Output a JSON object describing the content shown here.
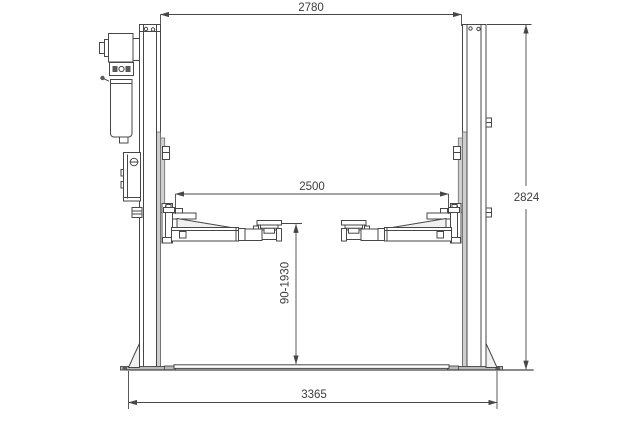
{
  "drawing": {
    "title": "Two-post car lift dimensional drawing (front view)",
    "view": "front elevation with floor plate",
    "dimensions": {
      "top_width": "2780",
      "arm_span": "2500",
      "column_height": "2824",
      "lift_height_range": "90-1930",
      "base_width": "3365"
    },
    "components": [
      "left column",
      "right column",
      "motor",
      "hydraulic pump",
      "oil tank",
      "control box",
      "lift carriage",
      "telescopic swing arm",
      "lift pad",
      "floor cover plate",
      "base plate",
      "column gusset"
    ],
    "colors": {
      "line": "#474747",
      "shading": "#cfcfcf",
      "plate_gray": "#b9b9b9",
      "background": "#ffffff"
    }
  }
}
